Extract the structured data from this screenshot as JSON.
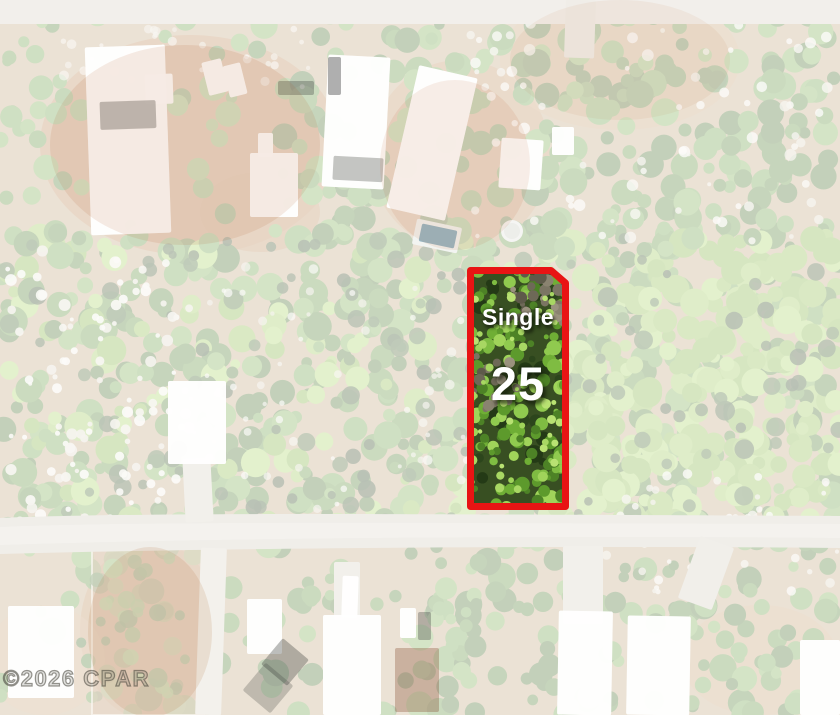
{
  "lot": {
    "type_label": "Single",
    "number": "25",
    "border_color": "#e81414",
    "text_color": "#ffffff"
  },
  "watermark": {
    "text": "©2026 CPAR"
  }
}
